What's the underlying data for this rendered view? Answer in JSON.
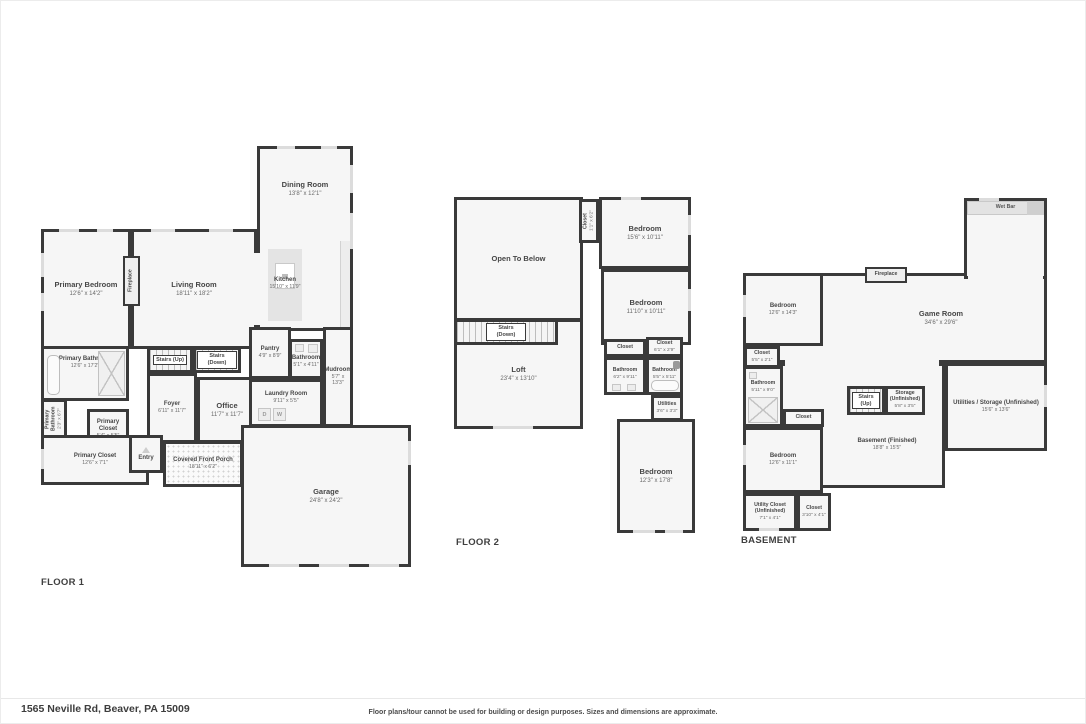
{
  "page": {
    "address": "1565 Neville Rd, Beaver, PA 15009",
    "disclaimer": "Floor plans/tour cannot be used for building or design purposes. Sizes and dimensions are approximate.",
    "wall_color": "#3a3a3a",
    "room_fill": "#f6f6f6"
  },
  "floor1": {
    "label": "FLOOR 1",
    "rooms": {
      "dining_room": {
        "name": "Dining Room",
        "dims": "13'8\" x 12'1\""
      },
      "kitchen": {
        "name": "Kitchen",
        "dims": "15'10\" x 11'9\""
      },
      "living_room": {
        "name": "Living Room",
        "dims": "18'11\" x 18'2\""
      },
      "primary_bedroom": {
        "name": "Primary Bedroom",
        "dims": "12'6\" x 14'2\""
      },
      "fireplace": {
        "name": "Fireplace"
      },
      "primary_bathroom": {
        "name": "Primary Bathroom",
        "dims": "12'6\" x 17'2\""
      },
      "primary_bathroom_2": {
        "name": "Primary Bathroom",
        "dims": "2'3\" x 6'7\""
      },
      "stairs_up": {
        "name": "Stairs (Up)"
      },
      "stairs_down": {
        "name": "Stairs (Down)"
      },
      "pantry": {
        "name": "Pantry",
        "dims": "4'9\" x 8'9\""
      },
      "bathroom": {
        "name": "Bathroom",
        "dims": "5'1\" x 4'11\""
      },
      "mudroom": {
        "name": "Mudroom",
        "dims": "5'7\" x 13'3\""
      },
      "foyer": {
        "name": "Foyer",
        "dims": "6'11\" x 11'7\""
      },
      "office": {
        "name": "Office",
        "dims": "11'7\" x 11'7\""
      },
      "laundry_room": {
        "name": "Laundry Room",
        "dims": "9'11\" x 5'5\"",
        "dryer": "D",
        "washer": "W"
      },
      "primary_closet_small": {
        "name": "Primary Closet",
        "dims": "5'4\" x 5'5\""
      },
      "primary_closet": {
        "name": "Primary Closet",
        "dims": "12'6\" x 7'1\""
      },
      "entry": {
        "name": "Entry"
      },
      "covered_front_porch": {
        "name": "Covered Front Porch",
        "dims": "18'11\" x 6'2\""
      },
      "garage": {
        "name": "Garage",
        "dims": "24'8\" x 24'2\""
      }
    }
  },
  "floor2": {
    "label": "FLOOR 2",
    "rooms": {
      "open_to_below": {
        "name": "Open To Below"
      },
      "closet_1": {
        "name": "Closet",
        "dims": "1'1\" x 6'2\""
      },
      "bedroom_1": {
        "name": "Bedroom",
        "dims": "15'6\" x 10'11\""
      },
      "bedroom_2": {
        "name": "Bedroom",
        "dims": "11'10\" x 10'11\""
      },
      "stairs_down": {
        "name": "Stairs (Down)"
      },
      "loft": {
        "name": "Loft",
        "dims": "23'4\" x 13'10\""
      },
      "closet_2": {
        "name": "Closet"
      },
      "closet_3": {
        "name": "Closet",
        "dims": "6'1\" x 2'9\""
      },
      "bathroom_1": {
        "name": "Bathroom",
        "dims": "6'2\" x 9'11\""
      },
      "bathroom_2": {
        "name": "Bathroom",
        "dims": "5'5\" x 5'11\""
      },
      "utilities": {
        "name": "Utilities",
        "dims": "3'6\" x 3'3\""
      },
      "bedroom_3": {
        "name": "Bedroom",
        "dims": "12'3\" x 17'8\""
      }
    }
  },
  "basement": {
    "label": "BASEMENT",
    "rooms": {
      "wet_bar": {
        "name": "Wet Bar"
      },
      "fireplace": {
        "name": "Fireplace"
      },
      "game_room": {
        "name": "Game Room",
        "dims": "34'6\" x 29'6\""
      },
      "bedroom_1": {
        "name": "Bedroom",
        "dims": "12'6\" x 14'3\""
      },
      "closet_1": {
        "name": "Closet",
        "dims": "5'5\" x 2'1\""
      },
      "bathroom": {
        "name": "Bathroom",
        "dims": "5'11\" x 9'0\""
      },
      "closet_2": {
        "name": "Closet"
      },
      "stairs_up": {
        "name": "Stairs (Up)"
      },
      "storage": {
        "name": "Storage (Unfinished)",
        "dims": "5'8\" x 3'5\""
      },
      "utilities_storage": {
        "name": "Utilities / Storage (Unfinished)",
        "dims": "15'6\" x 13'6\""
      },
      "basement_finished": {
        "name": "Basement (Finished)",
        "dims": "18'8\" x 15'5\""
      },
      "bedroom_2": {
        "name": "Bedroom",
        "dims": "12'6\" x 11'1\""
      },
      "utility_closet": {
        "name": "Utility Closet (Unfinished)",
        "dims": "7'1\" x 4'1\""
      },
      "closet_3": {
        "name": "Closet",
        "dims": "3'10\" x 4'1\""
      }
    }
  }
}
